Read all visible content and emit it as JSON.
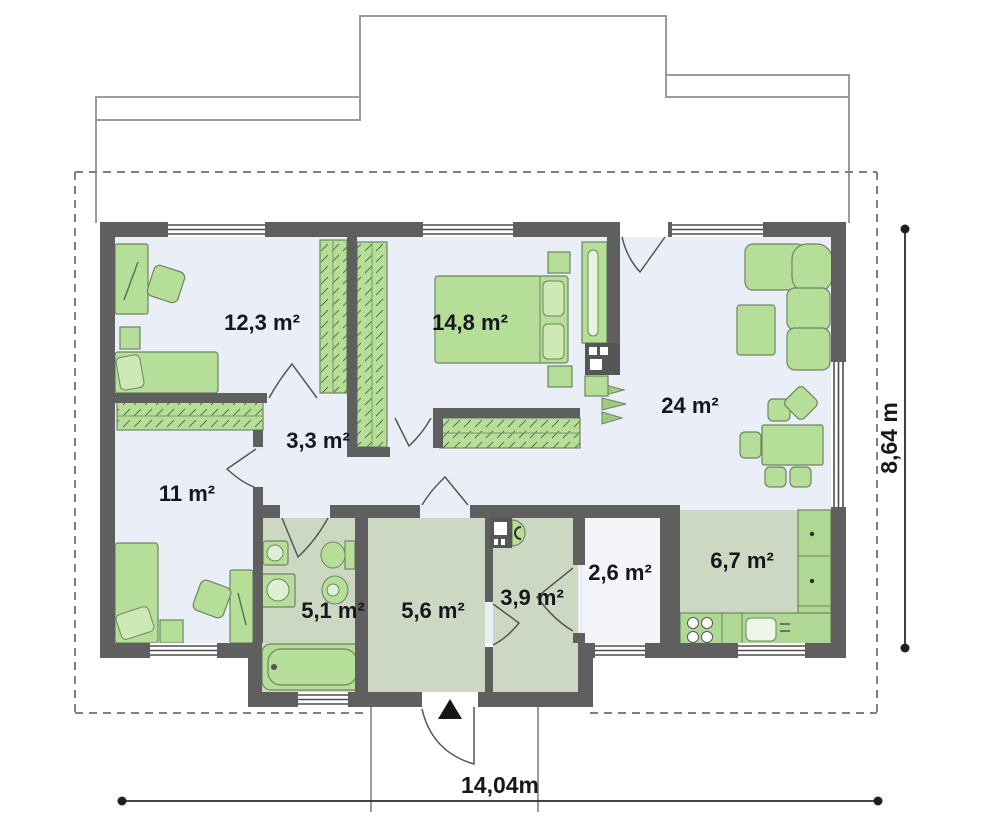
{
  "plan": {
    "rooms": [
      {
        "id": "bedroom-1",
        "label": "12,3 m²"
      },
      {
        "id": "bedroom-2",
        "label": "14,8 m²"
      },
      {
        "id": "living-room",
        "label": "24 m²"
      },
      {
        "id": "hallway",
        "label": "3,3 m²"
      },
      {
        "id": "bedroom-3",
        "label": "11 m²"
      },
      {
        "id": "bathroom",
        "label": "5,1 m²"
      },
      {
        "id": "vestibule",
        "label": "5,6 m²"
      },
      {
        "id": "utility",
        "label": "3,9 m²"
      },
      {
        "id": "pantry",
        "label": "2,6 m²"
      },
      {
        "id": "kitchen",
        "label": "6,7 m²"
      }
    ],
    "dimensions": {
      "overall_width": "14,04m",
      "overall_depth": "8,64 m"
    },
    "colors": {
      "wall": "#5f5f5f",
      "floor_main": "#e9eef7",
      "floor_wet": "#ccd8c1",
      "floor_pantry": "#f3f5f8",
      "furniture": "#b5df99",
      "marker": "#1a1a1a"
    }
  }
}
